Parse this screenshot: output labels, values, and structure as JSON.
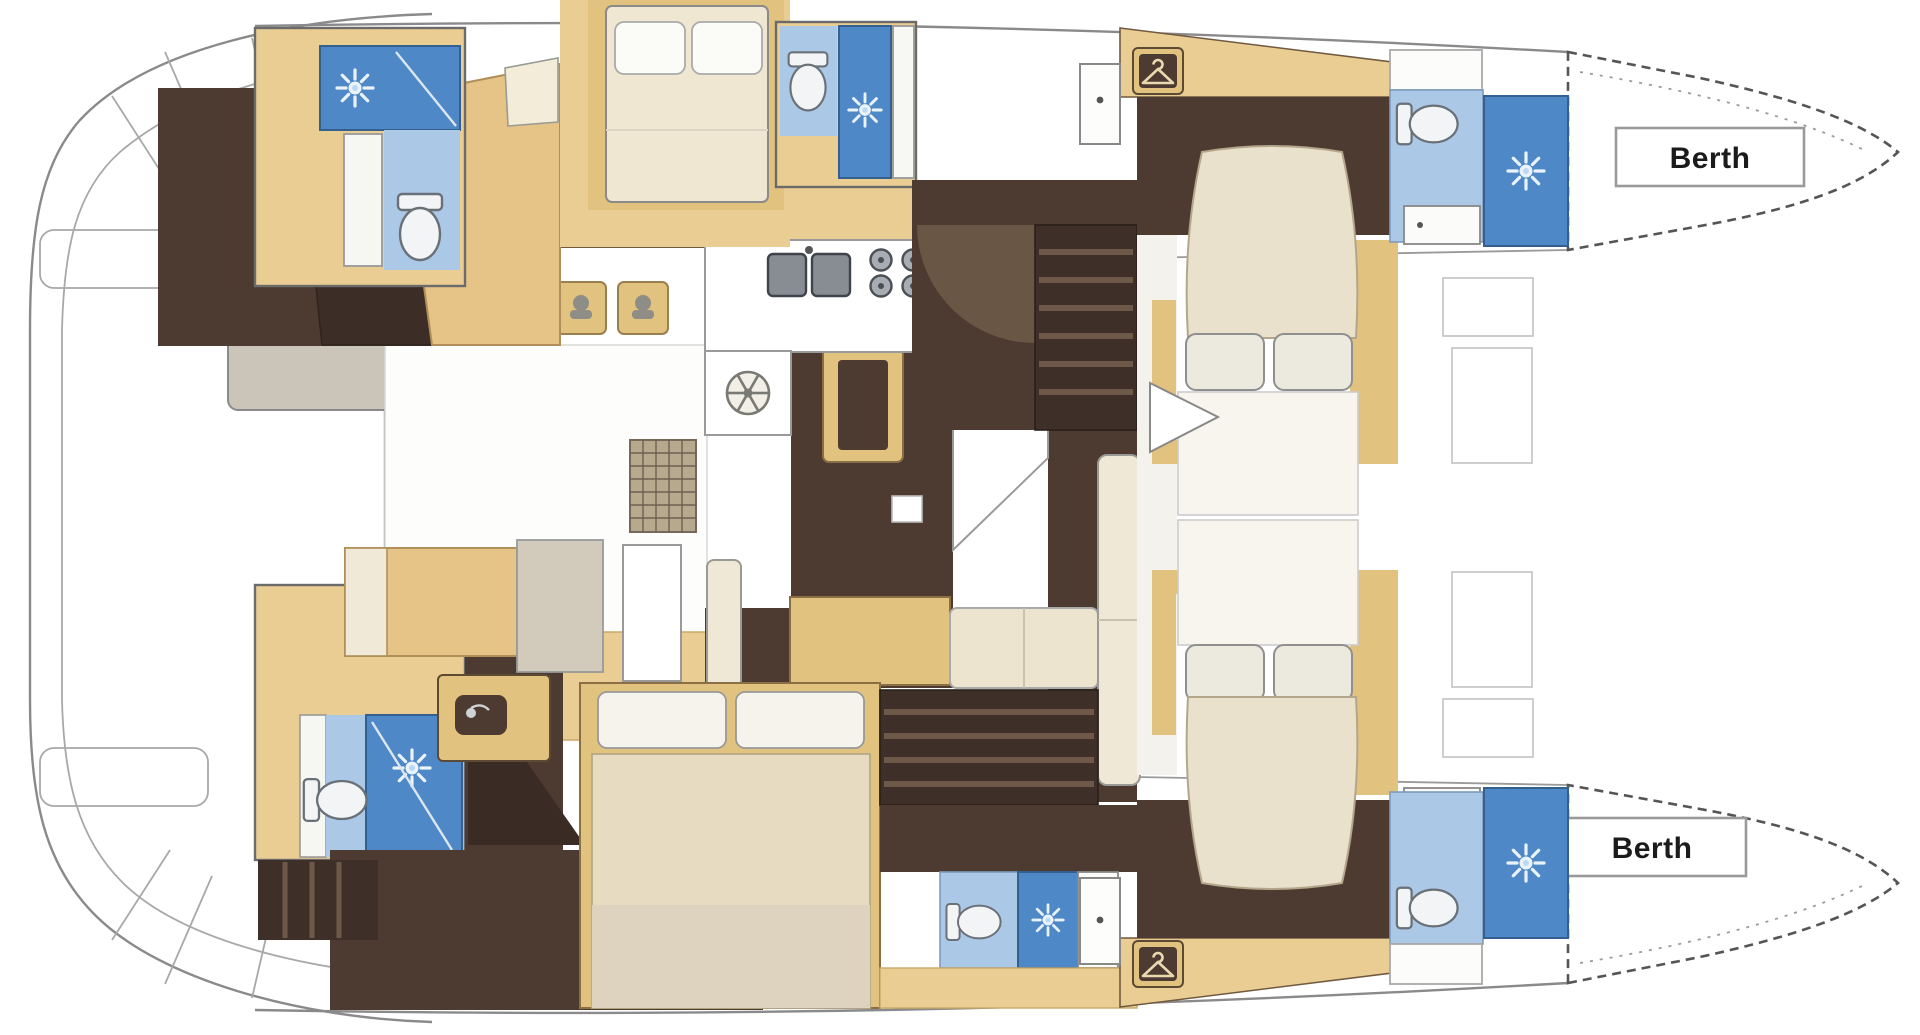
{
  "diagram": {
    "kind": "catamaran-interior-floor-plan",
    "labels": {
      "berth_fore": "Berth",
      "berth_aft": "Berth"
    },
    "palette": {
      "wood": "#e9cd93",
      "wood_dark": "#e2c27f",
      "floor_dark": "#4d3a31",
      "floor_shadow": "#3e2f28",
      "shower_blue": "#4e88c7",
      "bath_blue": "#abc8e6",
      "bed_cream": "#eae1cc",
      "linen_white": "#f7f5ee",
      "lounge_gray": "#cbc5b9",
      "counter_white": "#ffffff",
      "outline_gray": "#8a8a8a"
    },
    "icons": [
      "shower-icon",
      "toilet-icon",
      "sink-icon",
      "double-sink-icon",
      "stove-burner-icon",
      "oven-icon",
      "helm-wheel-icon",
      "hanger-icon",
      "stool-icon",
      "table-icon"
    ]
  }
}
